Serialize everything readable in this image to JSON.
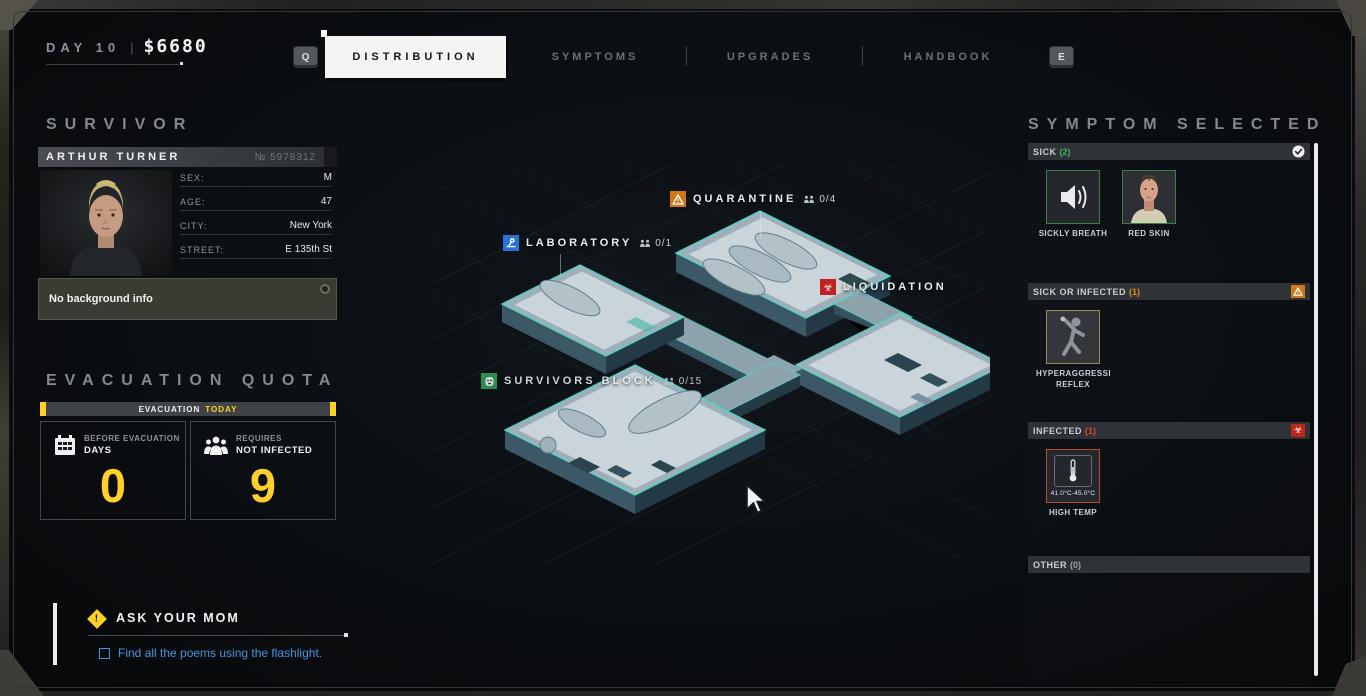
{
  "topbar": {
    "day": "DAY 10",
    "divider": "|",
    "money": "$6680",
    "key_left": "Q",
    "key_right": "E",
    "tabs": [
      {
        "label": "DISTRIBUTION",
        "active": true
      },
      {
        "label": "SYMPTOMS",
        "active": false
      },
      {
        "label": "UPGRADES",
        "active": false
      },
      {
        "label": "HANDBOOK",
        "active": false
      }
    ]
  },
  "survivor": {
    "section_title": "SURVIVOR",
    "name": "ARTHUR TURNER",
    "id": "№ 5978312",
    "fields": [
      {
        "label": "SEX:",
        "value": "M"
      },
      {
        "label": "AGE:",
        "value": "47"
      },
      {
        "label": "CITY:",
        "value": "New York"
      },
      {
        "label": "STREET:",
        "value": "E 135th St"
      }
    ],
    "background_note": "No background info"
  },
  "evacuation": {
    "section_title": "EVACUATION QUOTA",
    "banner_label": "EVACUATION",
    "banner_highlight": "TODAY",
    "accent_color": "#ffd028",
    "cards": [
      {
        "icon": "calendar-icon",
        "subtitle": "BEFORE EVACUATION",
        "title": "DAYS",
        "value": "0"
      },
      {
        "icon": "people-icon",
        "subtitle": "REQUIRES",
        "title": "NOT INFECTED",
        "value": "9"
      }
    ]
  },
  "quest": {
    "title": "ASK YOUR MOM",
    "objective": "Find all the poems using the flashlight.",
    "link_color": "#4596e0"
  },
  "map": {
    "locations": [
      {
        "name": "LABORATORY",
        "count": "0/1",
        "icon": "microscope-icon",
        "icon_color": "#2b6fd8"
      },
      {
        "name": "QUARANTINE",
        "count": "0/4",
        "icon": "warning-icon",
        "icon_color": "#d07818"
      },
      {
        "name": "LIQUIDATION",
        "count": "",
        "icon": "biohazard-icon",
        "icon_color": "#c41f1f"
      },
      {
        "name": "SURVIVORS BLOCK",
        "count": "0/15",
        "icon": "mask-icon",
        "icon_color": "#2f9e57"
      }
    ]
  },
  "symptoms": {
    "section_title": "SYMPTOM SELECTED",
    "biohazard_glyph": "☣",
    "sections": [
      {
        "label": "SICK",
        "count": "(2)",
        "badge": "shield-check-icon",
        "cards": [
          {
            "label": "SICKLY BREATH"
          },
          {
            "label": "RED SKIN"
          }
        ]
      },
      {
        "label": "SICK OR INFECTED",
        "count": "(1)",
        "badge": "warning-icon",
        "cards": [
          {
            "label": "HYPERAGGRESSIVE REFLEX"
          }
        ]
      },
      {
        "label": "INFECTED",
        "count": "(1)",
        "badge": "biohazard-icon",
        "cards": [
          {
            "label": "HIGH TEMP",
            "range": "41.0°C-45.0°C"
          }
        ]
      },
      {
        "label": "OTHER",
        "count": "(0)",
        "badge": "",
        "cards": []
      }
    ]
  }
}
